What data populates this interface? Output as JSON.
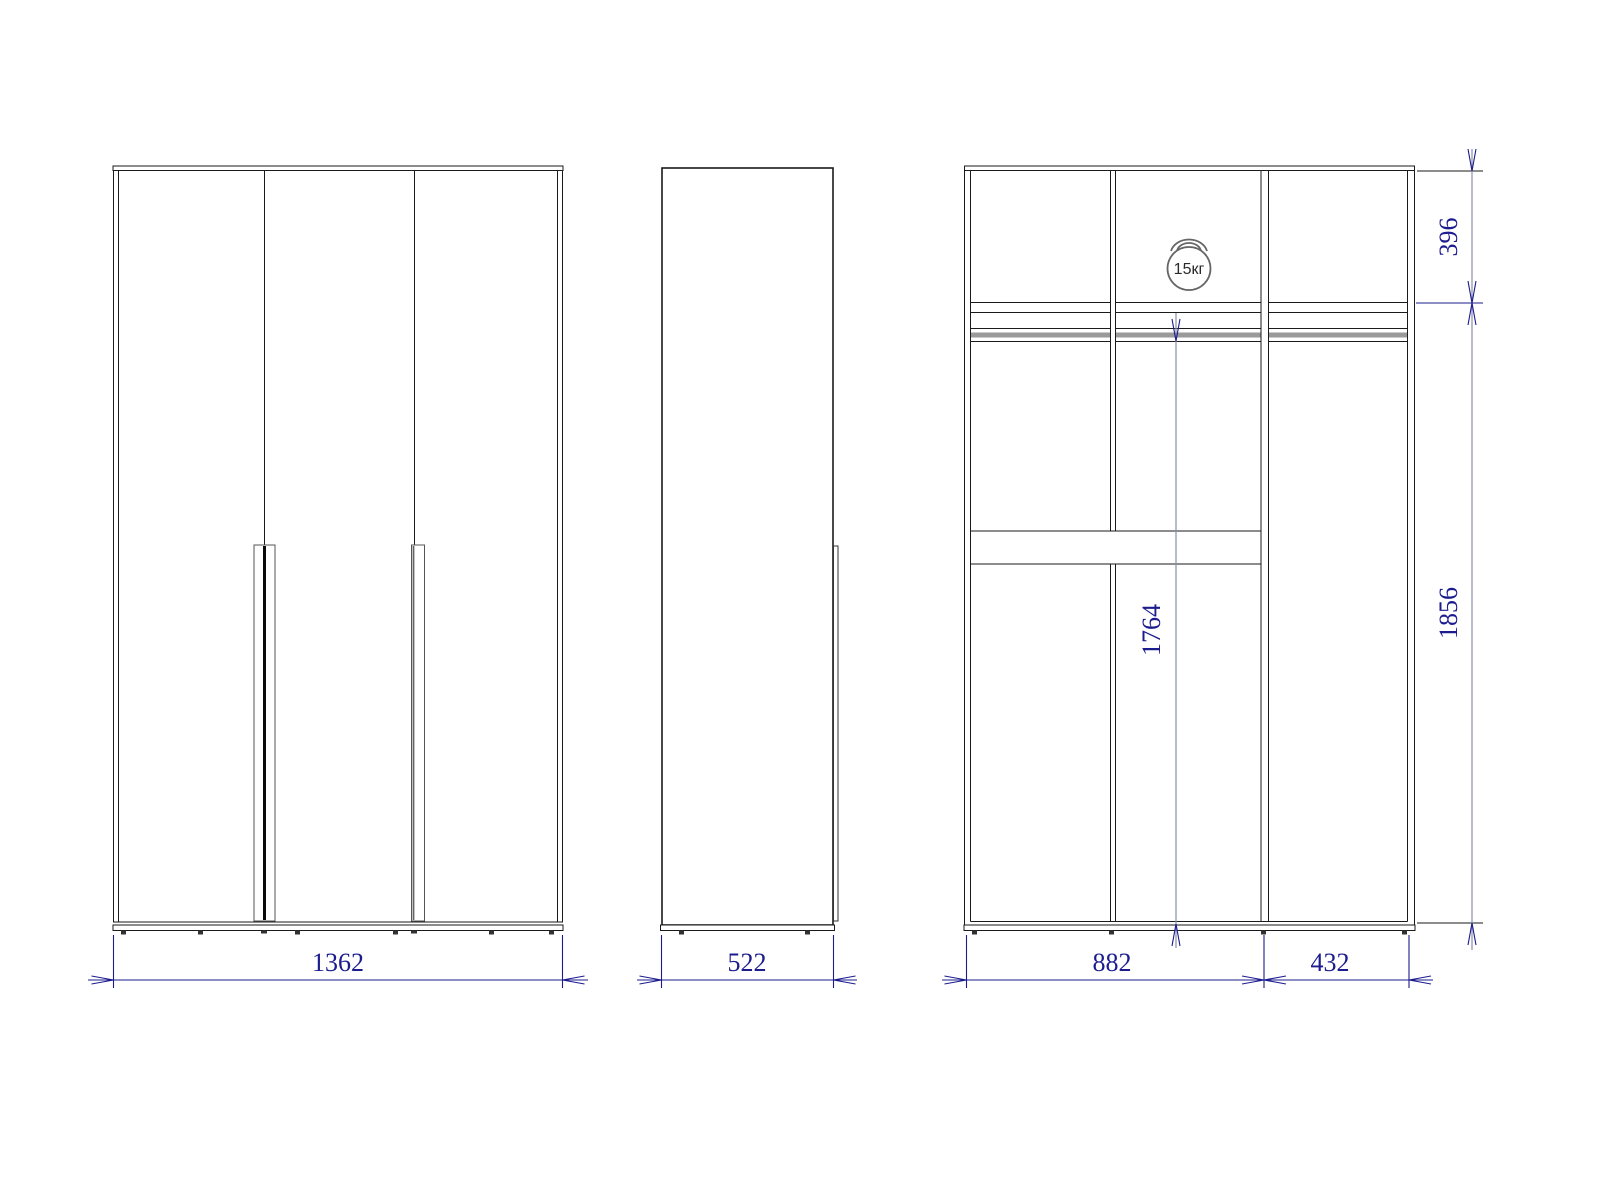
{
  "page": {
    "background": "#ffffff",
    "description": "Three-view technical drawing of a three-door wardrobe"
  },
  "views": {
    "front": {
      "name": "front-view"
    },
    "side": {
      "name": "side-view"
    },
    "internal": {
      "name": "internal-structure-view"
    }
  },
  "dimensions": {
    "overall_width": "1362",
    "depth": "522",
    "left_sections_width": "882",
    "right_section_width": "432",
    "top_shelf_height": "396",
    "side_section_height": "1856",
    "hanging_space_height": "1764"
  },
  "annotations": {
    "max_load": "15кг"
  },
  "colors": {
    "outline": "#1a1a1a",
    "dimension": "#1c1c8f",
    "auxiliary": "#8a90a8",
    "shading": "#9a9a9a",
    "background": "#ffffff"
  }
}
